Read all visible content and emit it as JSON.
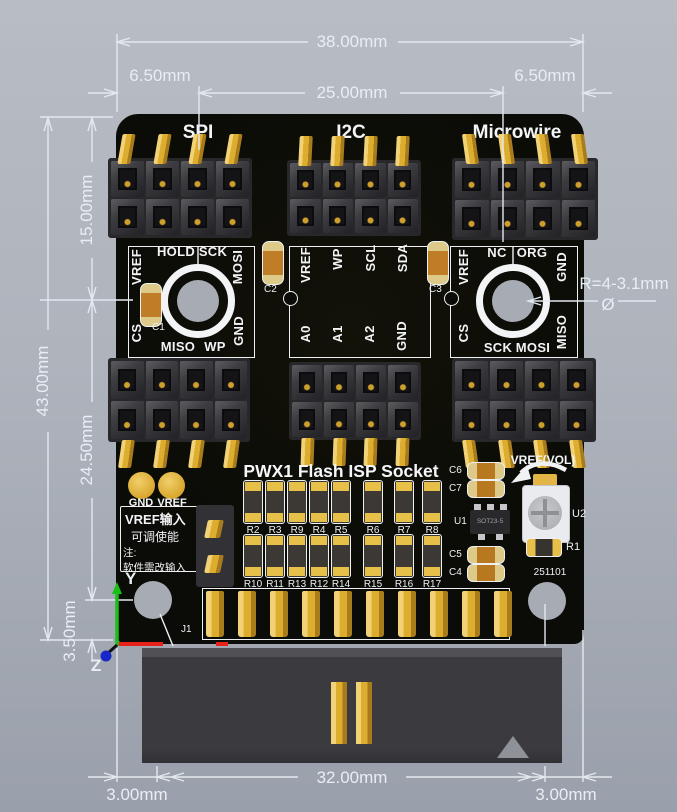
{
  "dimensions": {
    "total_width": "38.00mm",
    "inner_width": "25.00mm",
    "left_margin": "6.50mm",
    "right_margin": "6.50mm",
    "total_height": "43.00mm",
    "top_height": "15.00mm",
    "mid_height": "24.50mm",
    "bottom_offset": "3.50mm",
    "connector_left_margin": "3.00mm",
    "connector_width": "32.00mm",
    "connector_right_margin": "3.00mm",
    "hole_note": "R=4-3.1mm",
    "diameter_symbol": "Ø"
  },
  "axes": {
    "y": "Y",
    "z": "Z"
  },
  "board": {
    "title": "PWX1 Flash ISP Socket",
    "date_code": "251101",
    "connector_ref": "J1",
    "sections": [
      {
        "name": "SPI",
        "cap": "C1",
        "pins_top": [
          "VREF",
          "HOLD",
          "SCK",
          "MOSI"
        ],
        "pins_bottom": [
          "CS",
          "MISO",
          "WP",
          "GND"
        ]
      },
      {
        "name": "I2C",
        "cap": "C2",
        "pins_top": [
          "VREF",
          "WP",
          "SCL",
          "SDA"
        ],
        "pins_bottom": [
          "A0",
          "A1",
          "A2",
          "GND"
        ]
      },
      {
        "name": "Microwire",
        "cap": "C3",
        "pins_top": [
          "VREF",
          "NC",
          "ORG",
          "GND"
        ],
        "pins_bottom": [
          "CS",
          "SCK",
          "MOSI",
          "MISO"
        ]
      }
    ],
    "test_points": {
      "gnd": "GND",
      "vref": "VREF"
    },
    "note": {
      "line1": "VREF输入",
      "line2": "可调使能",
      "line3": "注:",
      "line4": "软件需改输入"
    },
    "resistors_row1": [
      "R2",
      "R3",
      "R9",
      "R4",
      "R5",
      "R6",
      "R7",
      "R8"
    ],
    "resistors_row2": [
      "R10",
      "R11",
      "R13",
      "R12",
      "R14",
      "R15",
      "R16",
      "R17"
    ],
    "right_caps": {
      "c6": "C6",
      "c7": "C7",
      "c5": "C5",
      "c4": "C4"
    },
    "u1": {
      "ref": "U1",
      "package": "SOT23-5"
    },
    "u2": {
      "ref": "U2",
      "note": "VREF(VOL)"
    },
    "r1": "R1"
  },
  "colors": {
    "gold": "#dfae33",
    "board": "#0b0b07",
    "silkscreen": "#f2f4f6",
    "dimension": "#e3e8f0",
    "axis_x": "#e82218",
    "axis_y": "#18c018",
    "axis_z": "#1828c8",
    "background_top": "#b8bcc4",
    "background_bottom": "#9aa0ab"
  }
}
